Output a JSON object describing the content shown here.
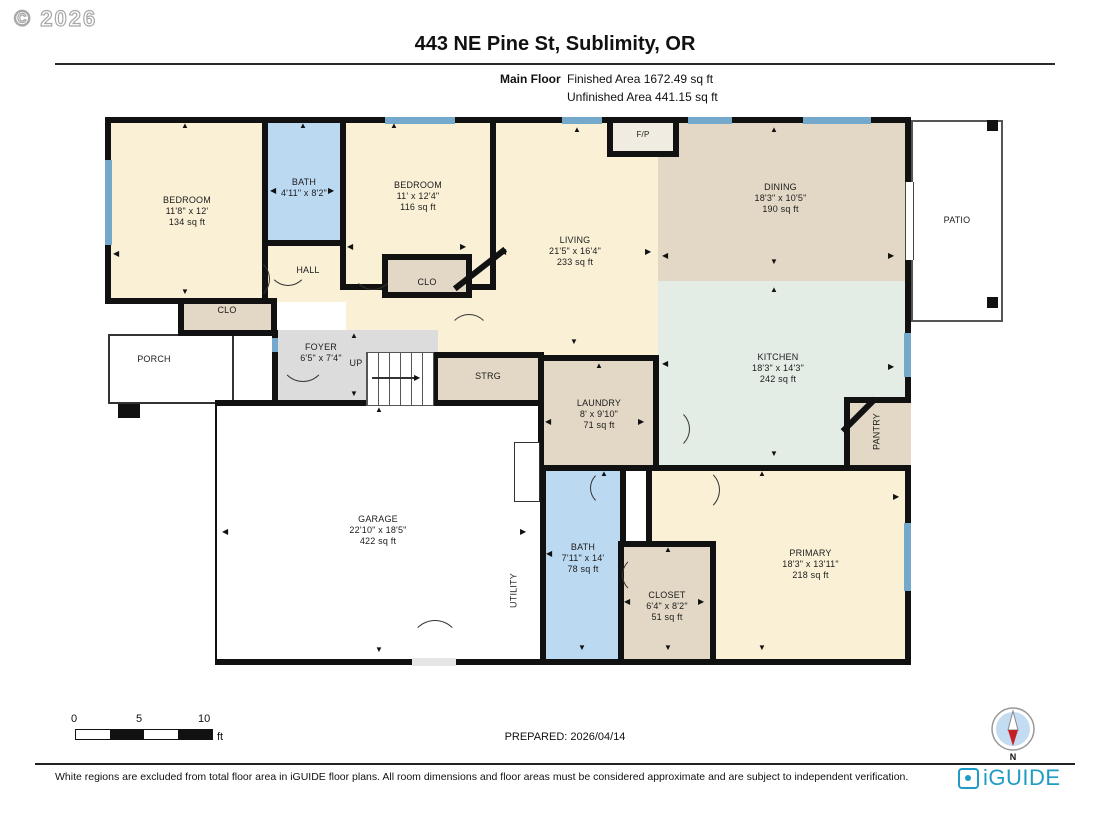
{
  "meta": {
    "copyright": "© 2026"
  },
  "header": {
    "title": "443 NE Pine St, Sublimity, OR",
    "floor_label": "Main Floor",
    "finished": "Finished Area 1672.49 sq ft",
    "unfinished": "Unfinished Area 441.15 sq ft"
  },
  "rooms": {
    "bedroom1": {
      "name": "BEDROOM",
      "dims": "11'8\" x 12'",
      "area": "134 sq ft"
    },
    "bath_main": {
      "name": "BATH",
      "dims": "4'11\" x 8'2\""
    },
    "hall": {
      "name": "HALL"
    },
    "bedroom2": {
      "name": "BEDROOM",
      "dims": "11' x 12'4\"",
      "area": "116 sq ft"
    },
    "clo_hall": {
      "name": "CLO"
    },
    "clo_bed2": {
      "name": "CLO"
    },
    "living": {
      "name": "LIVING",
      "dims": "21'5\" x 16'4\"",
      "area": "233 sq ft"
    },
    "fireplace": {
      "name": "F/P"
    },
    "dining": {
      "name": "DINING",
      "dims": "18'3\" x 10'5\"",
      "area": "190 sq ft"
    },
    "kitchen": {
      "name": "KITCHEN",
      "dims": "18'3\" x 14'3\"",
      "area": "242 sq ft"
    },
    "pantry": {
      "name": "PANTRY"
    },
    "patio": {
      "name": "PATIO"
    },
    "porch": {
      "name": "PORCH"
    },
    "foyer": {
      "name": "FOYER",
      "dims": "6'5\" x 7'4\""
    },
    "strg": {
      "name": "STRG"
    },
    "laundry": {
      "name": "LAUNDRY",
      "dims": "8' x 9'10\"",
      "area": "71 sq ft"
    },
    "garage": {
      "name": "GARAGE",
      "dims": "22'10\" x 18'5\"",
      "area": "422 sq ft"
    },
    "utility": {
      "name": "UTILITY"
    },
    "bath2": {
      "name": "BATH",
      "dims": "7'11\" x 14'",
      "area": "78 sq ft"
    },
    "closet_primary": {
      "name": "CLOSET",
      "dims": "6'4\" x 8'2\"",
      "area": "51 sq ft"
    },
    "primary": {
      "name": "PRIMARY",
      "dims": "18'3\" x 13'11\"",
      "area": "218 sq ft"
    }
  },
  "stairs": {
    "up": "UP"
  },
  "scalebar": {
    "t0": "0",
    "t1": "5",
    "t2": "10",
    "unit": "ft"
  },
  "compass": {
    "north": "N"
  },
  "brand": {
    "name": "iGUIDE"
  },
  "footer": {
    "prepared": "PREPARED: 2026/04/14",
    "disclaimer": "White regions are excluded from total floor area in iGUIDE floor plans. All room dimensions and floor areas must be considered approximate and are subject to independent verification."
  },
  "colors": {
    "wall": "#111111",
    "room_cream": "#FAF0D6",
    "room_tan": "#E2D8C5",
    "room_blue": "#BCD9F2",
    "room_mint": "#E3EDE6",
    "room_gray": "#DCDCDC",
    "window_blue": "#74A9CB",
    "brand_teal": "#1F9CC6",
    "compass_red": "#C42127"
  }
}
